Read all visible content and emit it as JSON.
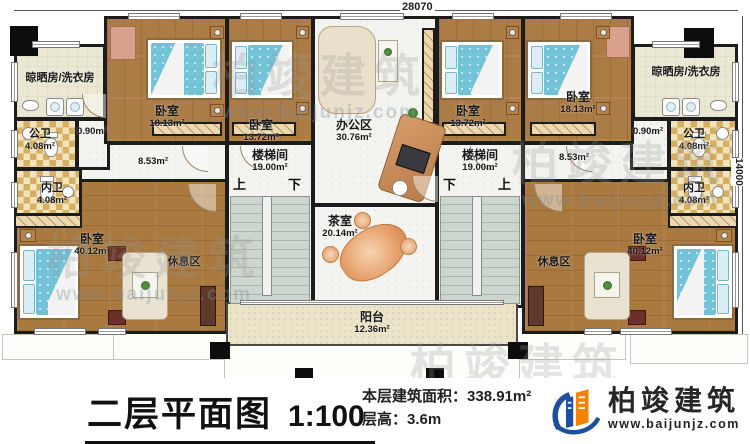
{
  "plan": {
    "dim_top": "28070",
    "dim_right": "14000",
    "stairs": {
      "up": "上",
      "down": "下"
    },
    "rooms": {
      "laundry_left": {
        "name": "晾晒房/洗衣房"
      },
      "laundry_right": {
        "name": "晾晒房/洗衣房"
      },
      "bedroom_18_left": {
        "name": "卧室",
        "area": "18.13m²"
      },
      "bedroom_13_left": {
        "name": "卧室",
        "area": "13.72m²"
      },
      "office": {
        "name": "办公区",
        "area": "30.76m²"
      },
      "bedroom_13_right": {
        "name": "卧室",
        "area": "13.72m²"
      },
      "bedroom_18_right": {
        "name": "卧室",
        "area": "18.13m²"
      },
      "public_bath_left": {
        "name": "公卫",
        "area": "4.08m²"
      },
      "public_bath_right": {
        "name": "公卫",
        "area": "4.08m²"
      },
      "private_bath_left": {
        "name": "内卫",
        "area": "4.08m²"
      },
      "private_bath_right": {
        "name": "内卫",
        "area": "4.08m²"
      },
      "lobby_left": {
        "area": "0.90m²"
      },
      "lobby_right": {
        "area": "0.90m²"
      },
      "corridor_left": {
        "area": "8.53m²"
      },
      "corridor_right": {
        "area": "8.53m²"
      },
      "stairwell_left": {
        "name": "楼梯间",
        "area": "19.00m²"
      },
      "stairwell_right": {
        "name": "楼梯间",
        "area": "19.00m²"
      },
      "tea_room": {
        "name": "茶室",
        "area": "20.14m²"
      },
      "bedroom_40_left": {
        "name": "卧室",
        "area": "40.12m²",
        "zone": "休息区"
      },
      "bedroom_40_right": {
        "name": "卧室",
        "area": "40.12m²",
        "zone": "休息区"
      },
      "balcony": {
        "name": "阳台",
        "area": "12.36m²"
      }
    }
  },
  "footer": {
    "title": "二层平面图",
    "scale": "1:100",
    "area_label": "本层建筑面积：",
    "area_value": "338.91m²",
    "height_label": "层高：",
    "height_value": "3.6m"
  },
  "brand": {
    "name": "柏竣建筑",
    "url": "www.baijunjz.com"
  },
  "watermark": {
    "text": "柏竣建筑",
    "url": "www.baijunjz.com"
  },
  "colors": {
    "wall": "#1c1c1c",
    "wood_floor": "#ac7c46",
    "bed_blue": "#72c2d8",
    "tile": "#d6af63",
    "brand_blue": "#1c4f9c",
    "brand_orange": "#f08300"
  }
}
